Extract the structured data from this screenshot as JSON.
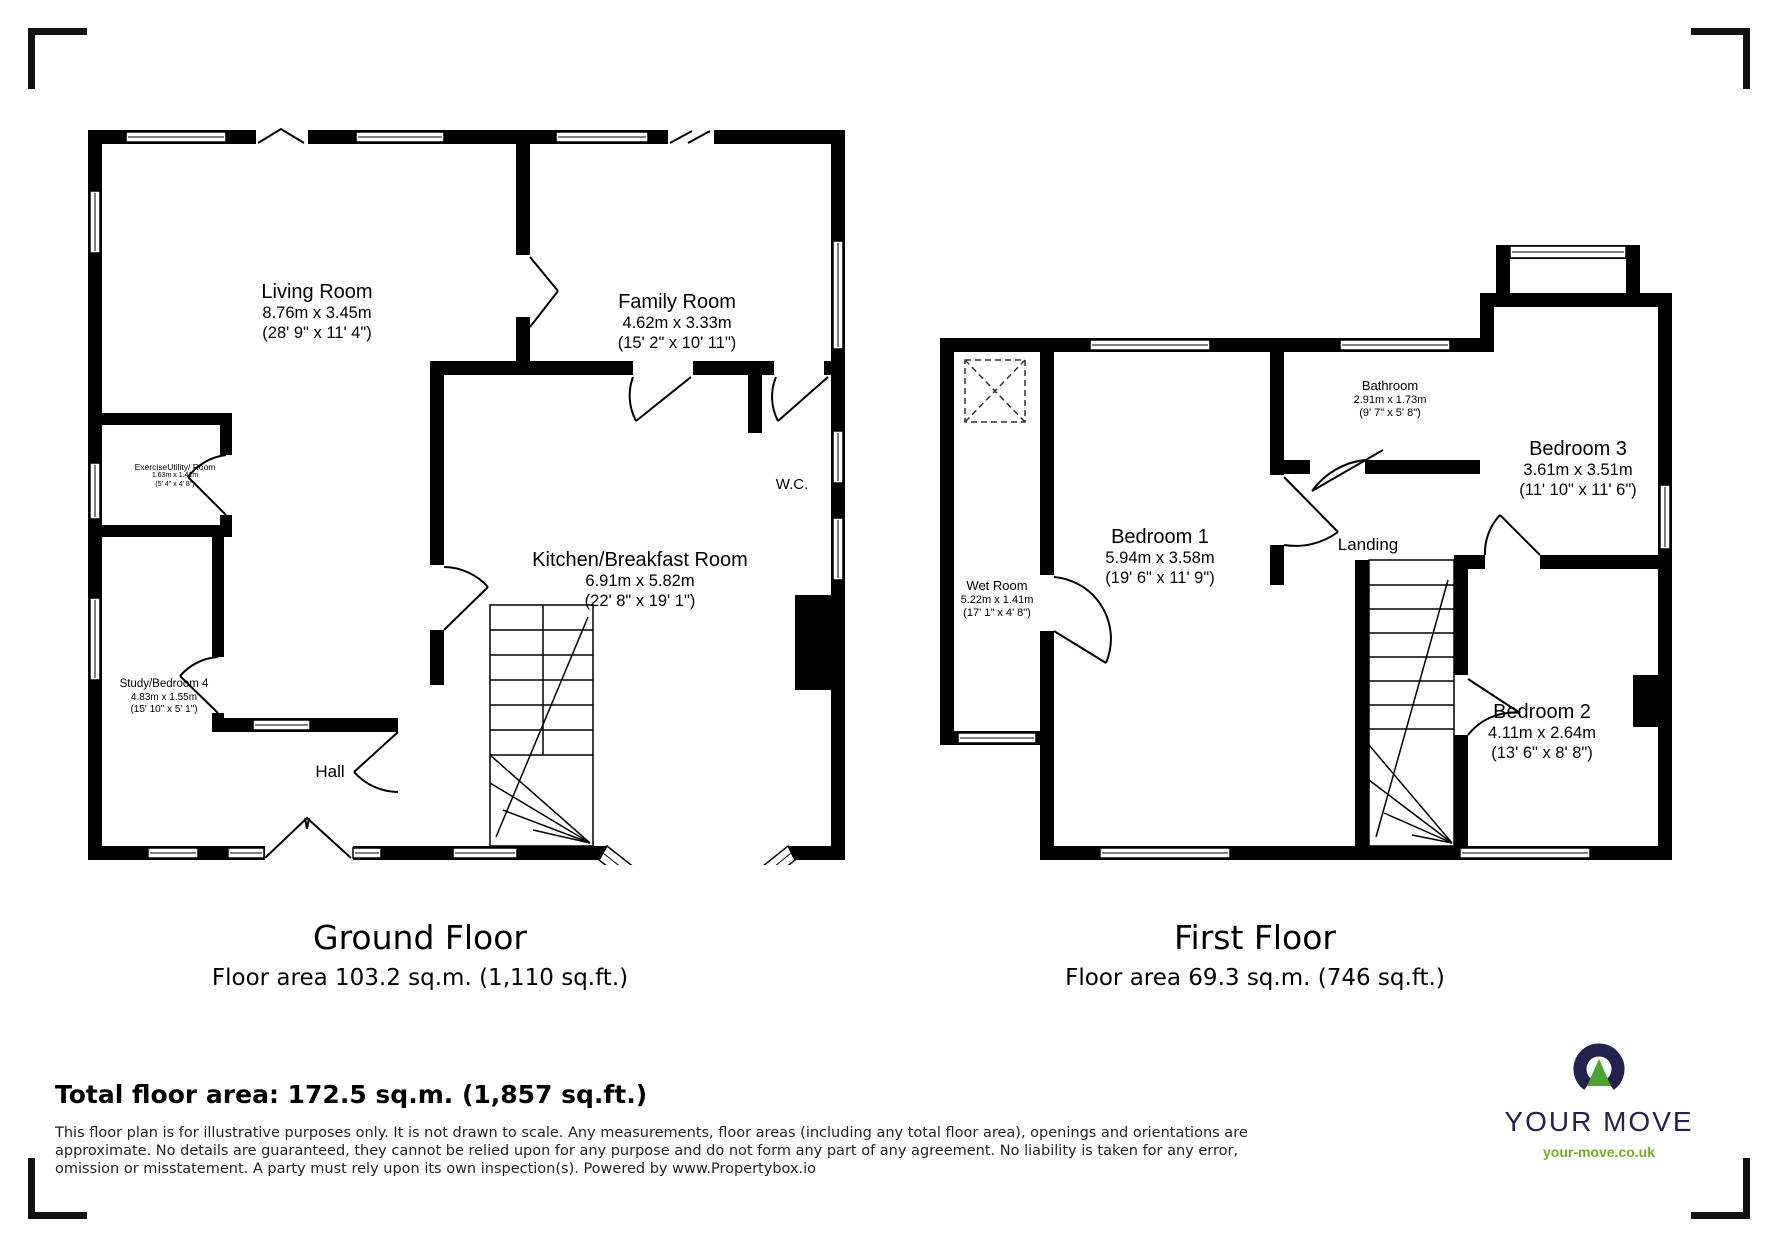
{
  "ground_floor": {
    "title": "Ground Floor",
    "area_line": "Floor area 103.2 sq.m. (1,110 sq.ft.)",
    "rooms": {
      "living": {
        "name": "Living Room",
        "metric": "8.76m x 3.45m",
        "imperial": "(28' 9\" x 11' 4\")"
      },
      "family": {
        "name": "Family Room",
        "metric": "4.62m x 3.33m",
        "imperial": "(15' 2\" x 10' 11\")"
      },
      "kitchen": {
        "name": "Kitchen/Breakfast Room",
        "metric": "6.91m x 5.82m",
        "imperial": "(22' 8\" x 19' 1\")"
      },
      "exercise": {
        "name": "ExerciseUtility/ Room",
        "metric": "1.63m x 1.41m",
        "imperial": "(5' 4\" x 4' 8\")"
      },
      "study": {
        "name": "Study/Bedroom 4",
        "metric": "4.83m x 1.55m",
        "imperial": "(15' 10\" x 5' 1\")"
      },
      "hall": {
        "name": "Hall"
      },
      "wc": {
        "name": "W.C."
      }
    }
  },
  "first_floor": {
    "title": "First Floor",
    "area_line": "Floor area 69.3 sq.m. (746 sq.ft.)",
    "rooms": {
      "bedroom1": {
        "name": "Bedroom 1",
        "metric": "5.94m x 3.58m",
        "imperial": "(19' 6\" x 11' 9\")"
      },
      "bedroom2": {
        "name": "Bedroom 2",
        "metric": "4.11m x 2.64m",
        "imperial": "(13' 6\" x 8' 8\")"
      },
      "bedroom3": {
        "name": "Bedroom 3",
        "metric": "3.61m x 3.51m",
        "imperial": "(11' 10\" x 11' 6\")"
      },
      "bathroom": {
        "name": "Bathroom",
        "metric": "2.91m x 1.73m",
        "imperial": "(9' 7\" x 5' 8\")"
      },
      "wet_room": {
        "name": "Wet Room",
        "metric": "5.22m x 1.41m",
        "imperial": "(17' 1\" x 4' 8\")"
      },
      "landing": {
        "name": "Landing"
      }
    }
  },
  "footer": {
    "total_area": "Total floor area: 172.5 sq.m. (1,857 sq.ft.)",
    "disclaimer": "This floor plan is for illustrative purposes only. It is not drawn to scale. Any measurements, floor areas (including any total floor area), openings and orientations are approximate. No details are guaranteed, they cannot be relied upon for any purpose and do not form any part of any agreement. No liability is taken for any error, omission or misstatement. A party must rely upon its own inspection(s). Powered by www.Propertybox.io"
  },
  "logo": {
    "brand": "YOUR MOVE",
    "url": "your-move.co.uk",
    "navy_color": "#23224e",
    "green_color": "#4ca32f",
    "url_green_color": "#71b02f"
  }
}
